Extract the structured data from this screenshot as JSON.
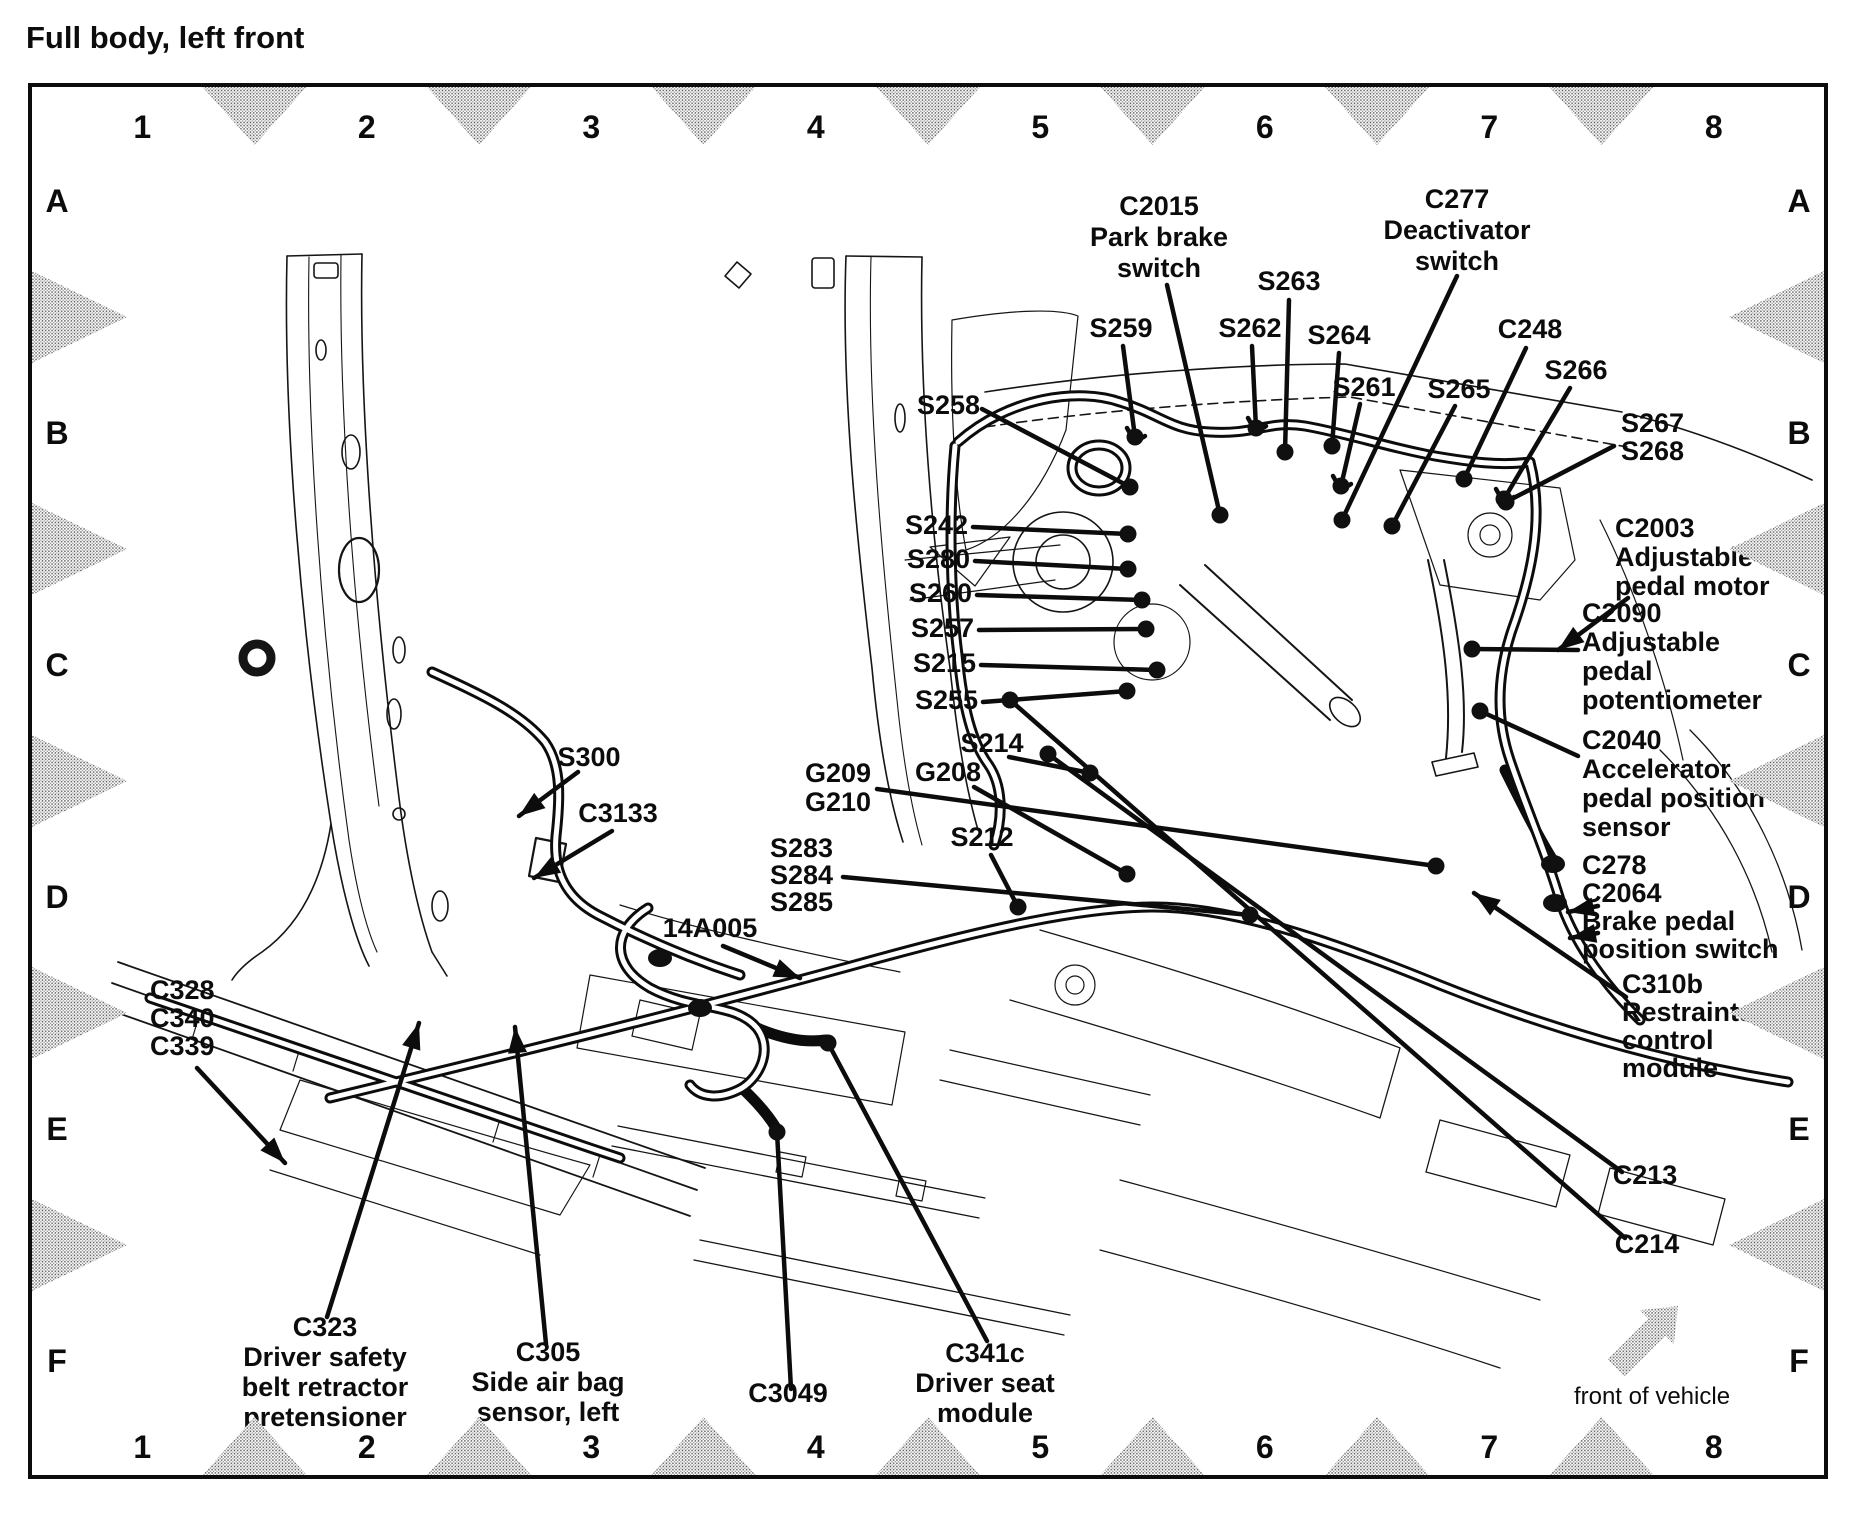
{
  "title": "Full body, left front",
  "ink": "#0c0c0c",
  "grid": {
    "columns": [
      "1",
      "2",
      "3",
      "4",
      "5",
      "6",
      "7",
      "8"
    ],
    "rows": [
      "A",
      "B",
      "C",
      "D",
      "E",
      "F"
    ]
  },
  "front_of_vehicle_label": "front of vehicle",
  "callouts": [
    {
      "id": "C2015",
      "x": 1159,
      "y": 215,
      "anchor": "middle",
      "lines": [
        "C2015",
        "Park brake",
        "switch"
      ]
    },
    {
      "id": "C277",
      "x": 1457,
      "y": 208,
      "anchor": "middle",
      "lines": [
        "C277",
        "Deactivator",
        "switch"
      ]
    },
    {
      "id": "S263",
      "x": 1289,
      "y": 290,
      "anchor": "middle",
      "lines": [
        "S263"
      ]
    },
    {
      "id": "S259",
      "x": 1121,
      "y": 337,
      "anchor": "middle",
      "lines": [
        "S259"
      ]
    },
    {
      "id": "S262",
      "x": 1250,
      "y": 337,
      "anchor": "middle",
      "lines": [
        "S262"
      ]
    },
    {
      "id": "S264",
      "x": 1339,
      "y": 344,
      "anchor": "middle",
      "lines": [
        "S264"
      ]
    },
    {
      "id": "C248",
      "x": 1530,
      "y": 338,
      "anchor": "middle",
      "lines": [
        "C248"
      ]
    },
    {
      "id": "S266",
      "x": 1576,
      "y": 379,
      "anchor": "middle",
      "lines": [
        "S266"
      ]
    },
    {
      "id": "S261",
      "x": 1364,
      "y": 396,
      "anchor": "middle",
      "lines": [
        "S261"
      ]
    },
    {
      "id": "S265",
      "x": 1459,
      "y": 398,
      "anchor": "middle",
      "lines": [
        "S265"
      ]
    },
    {
      "id": "S267S268",
      "x": 1621,
      "y": 432,
      "anchor": "start",
      "lh": 28,
      "lines": [
        "S267",
        "S268"
      ]
    },
    {
      "id": "S258",
      "x": 980,
      "y": 414,
      "anchor": "end",
      "lines": [
        "S258"
      ]
    },
    {
      "id": "S242",
      "x": 968,
      "y": 534,
      "anchor": "end",
      "lines": [
        "S242"
      ]
    },
    {
      "id": "S280",
      "x": 970,
      "y": 568,
      "anchor": "end",
      "lines": [
        "S280"
      ]
    },
    {
      "id": "S260",
      "x": 972,
      "y": 602,
      "anchor": "end",
      "lines": [
        "S260"
      ]
    },
    {
      "id": "S257",
      "x": 974,
      "y": 637,
      "anchor": "end",
      "lines": [
        "S257"
      ]
    },
    {
      "id": "S215",
      "x": 976,
      "y": 672,
      "anchor": "end",
      "lines": [
        "S215"
      ]
    },
    {
      "id": "S255",
      "x": 978,
      "y": 709,
      "anchor": "end",
      "lines": [
        "S255"
      ]
    },
    {
      "id": "S214",
      "x": 992,
      "y": 752,
      "anchor": "middle",
      "lines": [
        "S214"
      ]
    },
    {
      "id": "G209G210",
      "x": 838,
      "y": 782,
      "anchor": "middle",
      "lh": 29,
      "lines": [
        "G209",
        "G210"
      ]
    },
    {
      "id": "G208",
      "x": 948,
      "y": 781,
      "anchor": "middle",
      "lines": [
        "G208"
      ]
    },
    {
      "id": "S212",
      "x": 982,
      "y": 846,
      "anchor": "middle",
      "lines": [
        "S212"
      ]
    },
    {
      "id": "S283S284S285",
      "x": 770,
      "y": 857,
      "anchor": "start",
      "lh": 27,
      "lines": [
        "S283",
        "S284",
        "S285"
      ]
    },
    {
      "id": "14A005",
      "x": 710,
      "y": 937,
      "anchor": "middle",
      "lines": [
        "14A005"
      ]
    },
    {
      "id": "S300",
      "x": 589,
      "y": 766,
      "anchor": "middle",
      "lines": [
        "S300"
      ]
    },
    {
      "id": "C3133",
      "x": 618,
      "y": 822,
      "anchor": "middle",
      "lines": [
        "C3133"
      ]
    },
    {
      "id": "C328C340C339",
      "x": 150,
      "y": 999,
      "anchor": "start",
      "lh": 28,
      "lines": [
        "C328",
        "C340",
        "C339"
      ]
    },
    {
      "id": "C2003",
      "x": 1615,
      "y": 537,
      "anchor": "start",
      "lh": 29,
      "lines": [
        "C2003",
        "Adjustable",
        "pedal motor"
      ]
    },
    {
      "id": "C2090",
      "x": 1582,
      "y": 622,
      "anchor": "start",
      "lh": 29,
      "lines": [
        "C2090",
        "Adjustable",
        "pedal",
        "potentiometer"
      ]
    },
    {
      "id": "C2040",
      "x": 1582,
      "y": 749,
      "anchor": "start",
      "lh": 29,
      "lines": [
        "C2040",
        "Accelerator",
        "pedal position",
        "sensor"
      ]
    },
    {
      "id": "C278C2064",
      "x": 1582,
      "y": 874,
      "anchor": "start",
      "lh": 28,
      "lines": [
        "C278",
        "C2064",
        "Brake pedal",
        "position switch"
      ]
    },
    {
      "id": "C310b",
      "x": 1622,
      "y": 993,
      "anchor": "start",
      "lh": 28,
      "lines": [
        "C310b",
        "Restraints",
        "control",
        "module"
      ]
    },
    {
      "id": "C213",
      "x": 1645,
      "y": 1184,
      "anchor": "middle",
      "lines": [
        "C213"
      ]
    },
    {
      "id": "C214",
      "x": 1647,
      "y": 1253,
      "anchor": "middle",
      "lines": [
        "C214"
      ]
    },
    {
      "id": "C323",
      "x": 325,
      "y": 1336,
      "anchor": "middle",
      "lh": 30,
      "lines": [
        "C323",
        "Driver safety",
        "belt retractor",
        "pretensioner"
      ]
    },
    {
      "id": "C305",
      "x": 548,
      "y": 1361,
      "anchor": "middle",
      "lh": 30,
      "lines": [
        "C305",
        "Side air bag",
        "sensor, left"
      ]
    },
    {
      "id": "C3049",
      "x": 788,
      "y": 1402,
      "anchor": "middle",
      "lines": [
        "C3049"
      ]
    },
    {
      "id": "C341c",
      "x": 985,
      "y": 1362,
      "anchor": "middle",
      "lh": 30,
      "lines": [
        "C341c",
        "Driver seat",
        "module"
      ]
    }
  ],
  "leaders": [
    {
      "id": "C2015",
      "from": [
        1167,
        285
      ],
      "to": [
        1220,
        515
      ],
      "node": "end"
    },
    {
      "id": "C277",
      "from": [
        1457,
        276
      ],
      "to": [
        1342,
        520
      ],
      "node": "end"
    },
    {
      "id": "S263",
      "from": [
        1289,
        300
      ],
      "to": [
        1285,
        452
      ],
      "node": "end"
    },
    {
      "id": "S259",
      "from": [
        1123,
        346
      ],
      "to": [
        1135,
        437
      ],
      "node": "end"
    },
    {
      "id": "S262",
      "from": [
        1252,
        346
      ],
      "to": [
        1256,
        428
      ],
      "node": "end"
    },
    {
      "id": "S264",
      "from": [
        1339,
        353
      ],
      "to": [
        1332,
        446
      ],
      "node": "end"
    },
    {
      "id": "C248",
      "from": [
        1526,
        348
      ],
      "to": [
        1464,
        479
      ],
      "node": "end"
    },
    {
      "id": "S266",
      "from": [
        1570,
        388
      ],
      "to": [
        1504,
        499
      ],
      "node": "end"
    },
    {
      "id": "S261",
      "from": [
        1360,
        404
      ],
      "to": [
        1341,
        486
      ],
      "node": "end"
    },
    {
      "id": "S265",
      "from": [
        1455,
        406
      ],
      "to": [
        1392,
        526
      ],
      "node": "end"
    },
    {
      "id": "S267S268",
      "from": [
        1614,
        446
      ],
      "to": [
        1506,
        502
      ],
      "node": "end"
    },
    {
      "id": "S258",
      "from": [
        982,
        409
      ],
      "to": [
        1130,
        487
      ],
      "node": "end"
    },
    {
      "id": "S242",
      "from": [
        973,
        527
      ],
      "to": [
        1128,
        534
      ],
      "node": "end"
    },
    {
      "id": "S280",
      "from": [
        975,
        561
      ],
      "to": [
        1128,
        569
      ],
      "node": "end"
    },
    {
      "id": "S260",
      "from": [
        977,
        595
      ],
      "to": [
        1142,
        600
      ],
      "node": "end"
    },
    {
      "id": "S257",
      "from": [
        979,
        630
      ],
      "to": [
        1146,
        629
      ],
      "node": "end"
    },
    {
      "id": "S215",
      "from": [
        981,
        665
      ],
      "to": [
        1157,
        670
      ],
      "node": "end"
    },
    {
      "id": "S255",
      "from": [
        983,
        702
      ],
      "to": [
        1127,
        691
      ],
      "node": "end"
    },
    {
      "id": "S214",
      "from": [
        1009,
        757
      ],
      "to": [
        1090,
        773
      ],
      "node": "end"
    },
    {
      "id": "G209G210",
      "from": [
        877,
        789
      ],
      "to": [
        1436,
        866
      ],
      "node": "end"
    },
    {
      "id": "G208",
      "from": [
        974,
        787
      ],
      "to": [
        1127,
        874
      ],
      "node": "end"
    },
    {
      "id": "S212",
      "from": [
        991,
        855
      ],
      "to": [
        1018,
        907
      ],
      "node": "end"
    },
    {
      "id": "S283S284S285",
      "from": [
        843,
        877
      ],
      "to": [
        1250,
        915
      ],
      "node": "end"
    },
    {
      "id": "14A005",
      "from": [
        723,
        946
      ],
      "to": [
        800,
        978
      ],
      "arrow": true
    },
    {
      "id": "S300",
      "from": [
        578,
        772
      ],
      "to": [
        519,
        816
      ],
      "arrow": true
    },
    {
      "id": "C3133",
      "from": [
        612,
        831
      ],
      "to": [
        534,
        878
      ],
      "arrow": true
    },
    {
      "id": "C328C340C339",
      "from": [
        197,
        1068
      ],
      "to": [
        285,
        1163
      ],
      "arrow": true
    },
    {
      "id": "C2003",
      "from": [
        1628,
        598
      ],
      "to": [
        1558,
        650
      ],
      "arrow": true
    },
    {
      "id": "C2090",
      "from": [
        1578,
        650
      ],
      "to": [
        1472,
        649
      ],
      "node": "end"
    },
    {
      "id": "C2040",
      "from": [
        1578,
        756
      ],
      "to": [
        1480,
        711
      ],
      "node": "end"
    },
    {
      "id": "C278a",
      "from": [
        1598,
        906
      ],
      "to": [
        1568,
        912
      ],
      "arrow": true
    },
    {
      "id": "C278b",
      "from": [
        1598,
        933
      ],
      "to": [
        1570,
        938
      ],
      "arrow": true
    },
    {
      "id": "C310b",
      "from": [
        1626,
        997
      ],
      "to": [
        1474,
        893
      ],
      "arrow": true
    },
    {
      "id": "C213",
      "from": [
        1048,
        754
      ],
      "to": [
        1622,
        1172
      ],
      "node": "start"
    },
    {
      "id": "C214",
      "from": [
        1010,
        700
      ],
      "to": [
        1625,
        1238
      ],
      "node": "start"
    },
    {
      "id": "C323",
      "from": [
        327,
        1317
      ],
      "to": [
        419,
        1023
      ],
      "arrow": true
    },
    {
      "id": "C305",
      "from": [
        546,
        1344
      ],
      "to": [
        515,
        1027
      ],
      "arrow": true
    },
    {
      "id": "C3049",
      "from": [
        791,
        1389
      ],
      "to": [
        777,
        1132
      ],
      "node": "end"
    },
    {
      "id": "C341c",
      "from": [
        987,
        1341
      ],
      "to": [
        828,
        1043
      ],
      "node": "end"
    }
  ],
  "extra_connectors": [
    [
      1555,
      903
    ],
    [
      1553,
      864
    ],
    [
      700,
      1008
    ],
    [
      660,
      958
    ]
  ]
}
